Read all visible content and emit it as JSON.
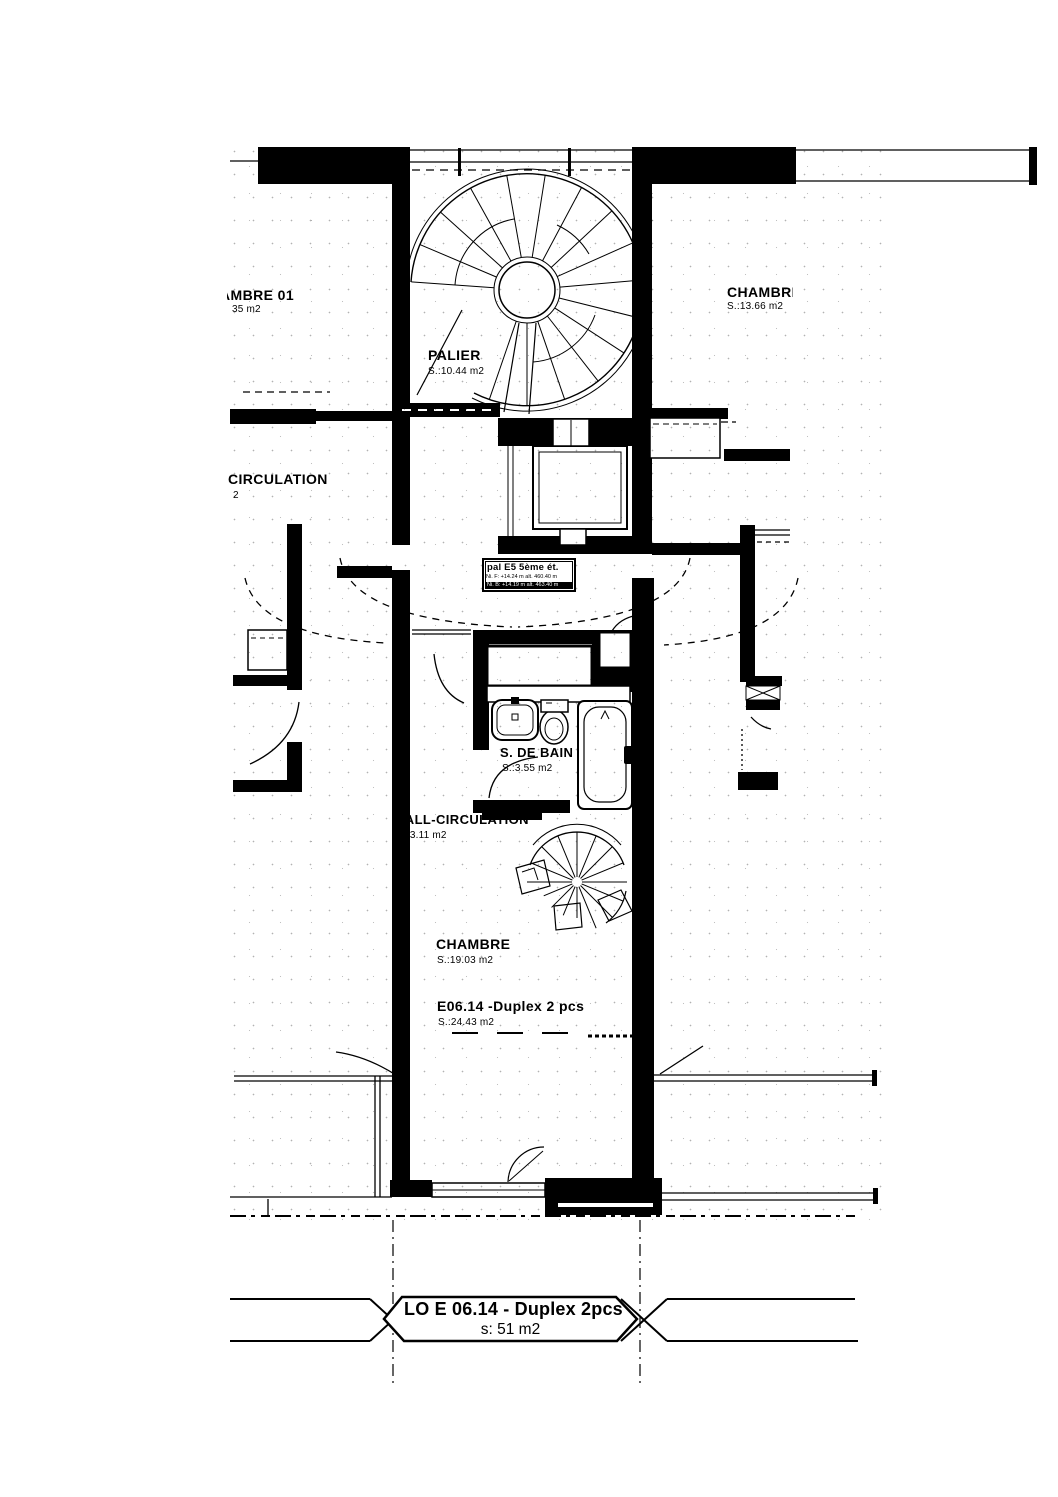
{
  "document": {
    "type": "architectural floor plan",
    "paper": "#ffffff",
    "ink": "#000000"
  },
  "labels": {
    "chambre01": {
      "name": "CHAMBRE 01",
      "area": "35 m2"
    },
    "chambre_ne": {
      "name": "CHAMBRE",
      "area": "S.:13.66 m2"
    },
    "palier": {
      "name": "PALIER",
      "area": "S.:10.44 m2"
    },
    "circulation": {
      "name": "CIRCULATION",
      "area": "2"
    },
    "level_tag": {
      "title": "pal E5 5ème ét.",
      "line1": "Ni. F: +14.24 m alt. 460.40 m",
      "line2": "Ni. B: +14.19 m alt. 463.40 m"
    },
    "salle_de_bain": {
      "name": "S. DE BAIN",
      "area": "S.:3.55 m2"
    },
    "hall": {
      "name": "HALL-CIRCULATION",
      "area": "S.:3.11 m2"
    },
    "chambre": {
      "name": "CHAMBRE",
      "area": "S.:19.03 m2"
    },
    "unit": {
      "name": "E06.14 -Duplex 2 pcs",
      "area": "S.:24.43 m2"
    },
    "title_block": {
      "line1": "LO E 06.14 - Duplex 2pcs",
      "line2": "s: 51 m2"
    }
  }
}
